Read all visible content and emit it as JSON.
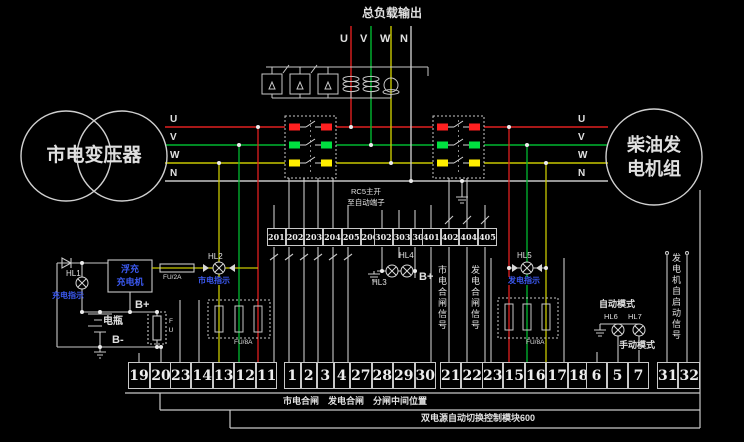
{
  "colors": {
    "phase_u_red": "#e02020",
    "phase_v_green": "#00b830",
    "phase_w_yellow": "#c8c800",
    "neutral_white": "#c8c8c8",
    "caption_blue": "#3b59f0"
  },
  "header": {
    "load_output_label": "总负载输出",
    "phases": [
      "U",
      "V",
      "W",
      "N"
    ]
  },
  "sources": {
    "mains_transformer": "市电变压器",
    "generator_line1": "柴油发",
    "generator_line2": "电机组"
  },
  "bus": {
    "left_labels": [
      "U",
      "V",
      "W",
      "N"
    ],
    "right_labels": [
      "U",
      "V",
      "W",
      "N"
    ]
  },
  "plug_note": {
    "line1": "RC5主开",
    "line2": "至自动端子"
  },
  "mid_terminals": {
    "group_a": [
      "201",
      "202",
      "203",
      "204",
      "205",
      "206"
    ],
    "group_b": [
      "302",
      "303",
      "305"
    ],
    "group_c": [
      "401",
      "402",
      "404",
      "405"
    ]
  },
  "charging": {
    "hl1_label": "HL1",
    "hl1_caption": "充电指示",
    "charger_line1": "浮充",
    "charger_line2": "充电机",
    "b_plus": "B+",
    "battery_label": "电瓶",
    "b_minus": "B-",
    "fuse_inline_label": "FU/2A",
    "fuse_vertical_label": "FU",
    "hl2_label": "HL2",
    "hl2_caption": "市电指示",
    "fuse_box_label": "FU/8A"
  },
  "signals": {
    "hl3_label": "HL3",
    "hl4_label": "HL4",
    "b_plus": "B+",
    "mains_close_signal": "市电合闸信号",
    "gen_close_signal": "发电合闸信号",
    "hl5_label": "HL5",
    "hl5_caption": "发电指示",
    "fuse_box_label": "FU/8A",
    "auto_mode": "自动模式",
    "hl6_label": "HL6",
    "hl7_label": "HL7",
    "manual_mode": "手动模式",
    "gen_autostart_signal": "发电机自启动信号"
  },
  "bottom_terminals": {
    "group1": [
      "19",
      "20"
    ],
    "group2": [
      "23",
      "14",
      "13",
      "12",
      "11"
    ],
    "group3": [
      "1",
      "2",
      "3",
      "4",
      "27",
      "28",
      "29",
      "30"
    ],
    "group4": [
      "21",
      "22"
    ],
    "group5": [
      "23",
      "15",
      "16",
      "17",
      "18"
    ],
    "group6": [
      "6",
      "5",
      "7"
    ],
    "group7": [
      "31",
      "32"
    ]
  },
  "footer": {
    "position_labels": "市电合闸　发电合闸　分闸中间位置",
    "module_name": "双电源自动切换控制模块600"
  }
}
